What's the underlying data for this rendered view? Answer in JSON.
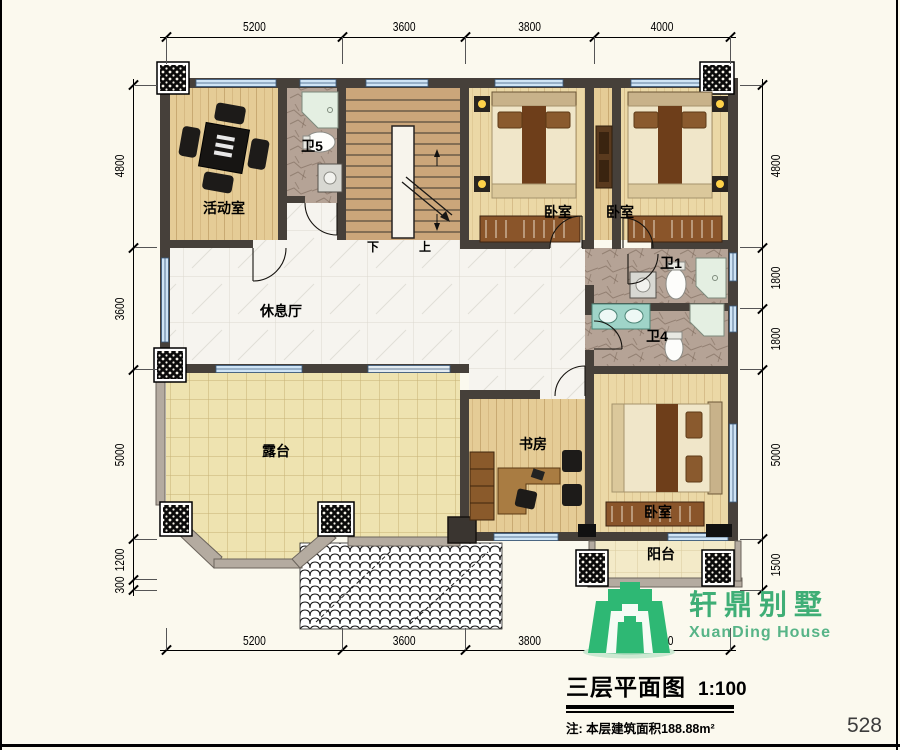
{
  "sheet": {
    "page_number": "528"
  },
  "dimensions": {
    "top": [
      "5200",
      "3600",
      "3800",
      "4000"
    ],
    "bottom": [
      "5200",
      "3600",
      "3800",
      "4000"
    ],
    "left": [
      "4800",
      "3600",
      "5000",
      "1200",
      "300"
    ],
    "right": [
      "4800",
      "1800",
      "1800",
      "5000",
      "1500"
    ]
  },
  "rooms": {
    "activity": "活动室",
    "bath5": "卫5",
    "bedroom1": "卧室",
    "bedroom2": "卧室",
    "bath1": "卫1",
    "bath4": "卫4",
    "lounge": "休息厅",
    "terrace": "露台",
    "study": "书房",
    "bedroom3": "卧室",
    "balcony": "阳台",
    "stair_down": "下",
    "stair_up": "上"
  },
  "branding": {
    "name_cn": "轩鼎别墅",
    "name_en": "XuanDing House"
  },
  "titleblock": {
    "title": "三层平面图",
    "scale": "1:100",
    "note": "注: 本层建筑面积188.88m²"
  },
  "colors": {
    "brand_green": "#2eb874",
    "wall": "#46403a",
    "window_blue": "#cfe4f5"
  }
}
